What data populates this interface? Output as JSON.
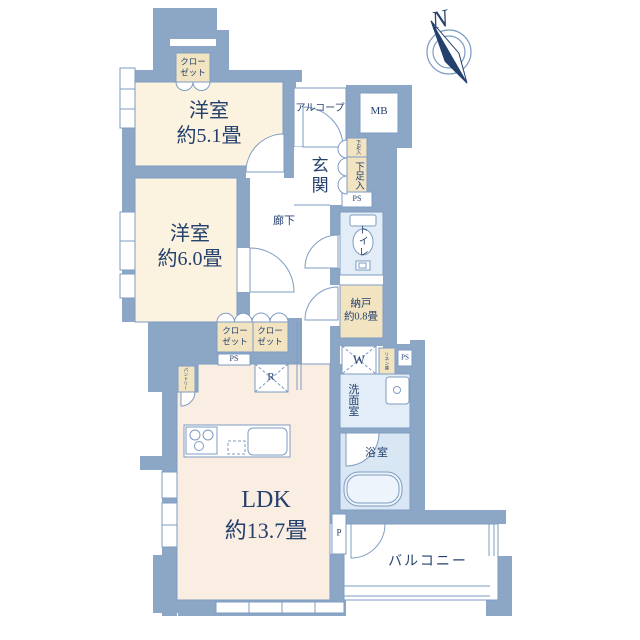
{
  "title": "マンション間取り図",
  "colors": {
    "wall": "#8CA6C6",
    "line": "#7E9CC2",
    "navy": "#24406D",
    "cream": "#FBF3DF",
    "peach": "#FAEDE2",
    "wet": "#E2EDF7",
    "wet2": "#D9E7F4",
    "beige": "#F2E4C1",
    "white": "#FFFFFF"
  },
  "compass": {
    "north": "N"
  },
  "rooms": {
    "bedroom1": {
      "name": "洋室",
      "size": "約5.1畳"
    },
    "bedroom2": {
      "name": "洋室",
      "size": "約6.0畳"
    },
    "ldk": {
      "name": "LDK",
      "size": "約13.7畳"
    },
    "storage_room": {
      "name": "納戸",
      "size": "約0.8畳"
    },
    "entrance": "玄関",
    "hallway": "廊下",
    "alcove": "アルコープ",
    "toilet": "トイレ",
    "washroom": "洗面室",
    "bathroom": "浴室",
    "balcony": "バルコニー"
  },
  "fixtures": {
    "closet": {
      "line1": "クロー",
      "line2": "ゼット"
    },
    "shoe_cabinet": "下足入",
    "meter_box": "MB",
    "pipe_space": "PS",
    "washer": "W",
    "refrigerator": "R",
    "pipe": "P",
    "linen": "リネン庫",
    "pantry": "パントリー"
  }
}
